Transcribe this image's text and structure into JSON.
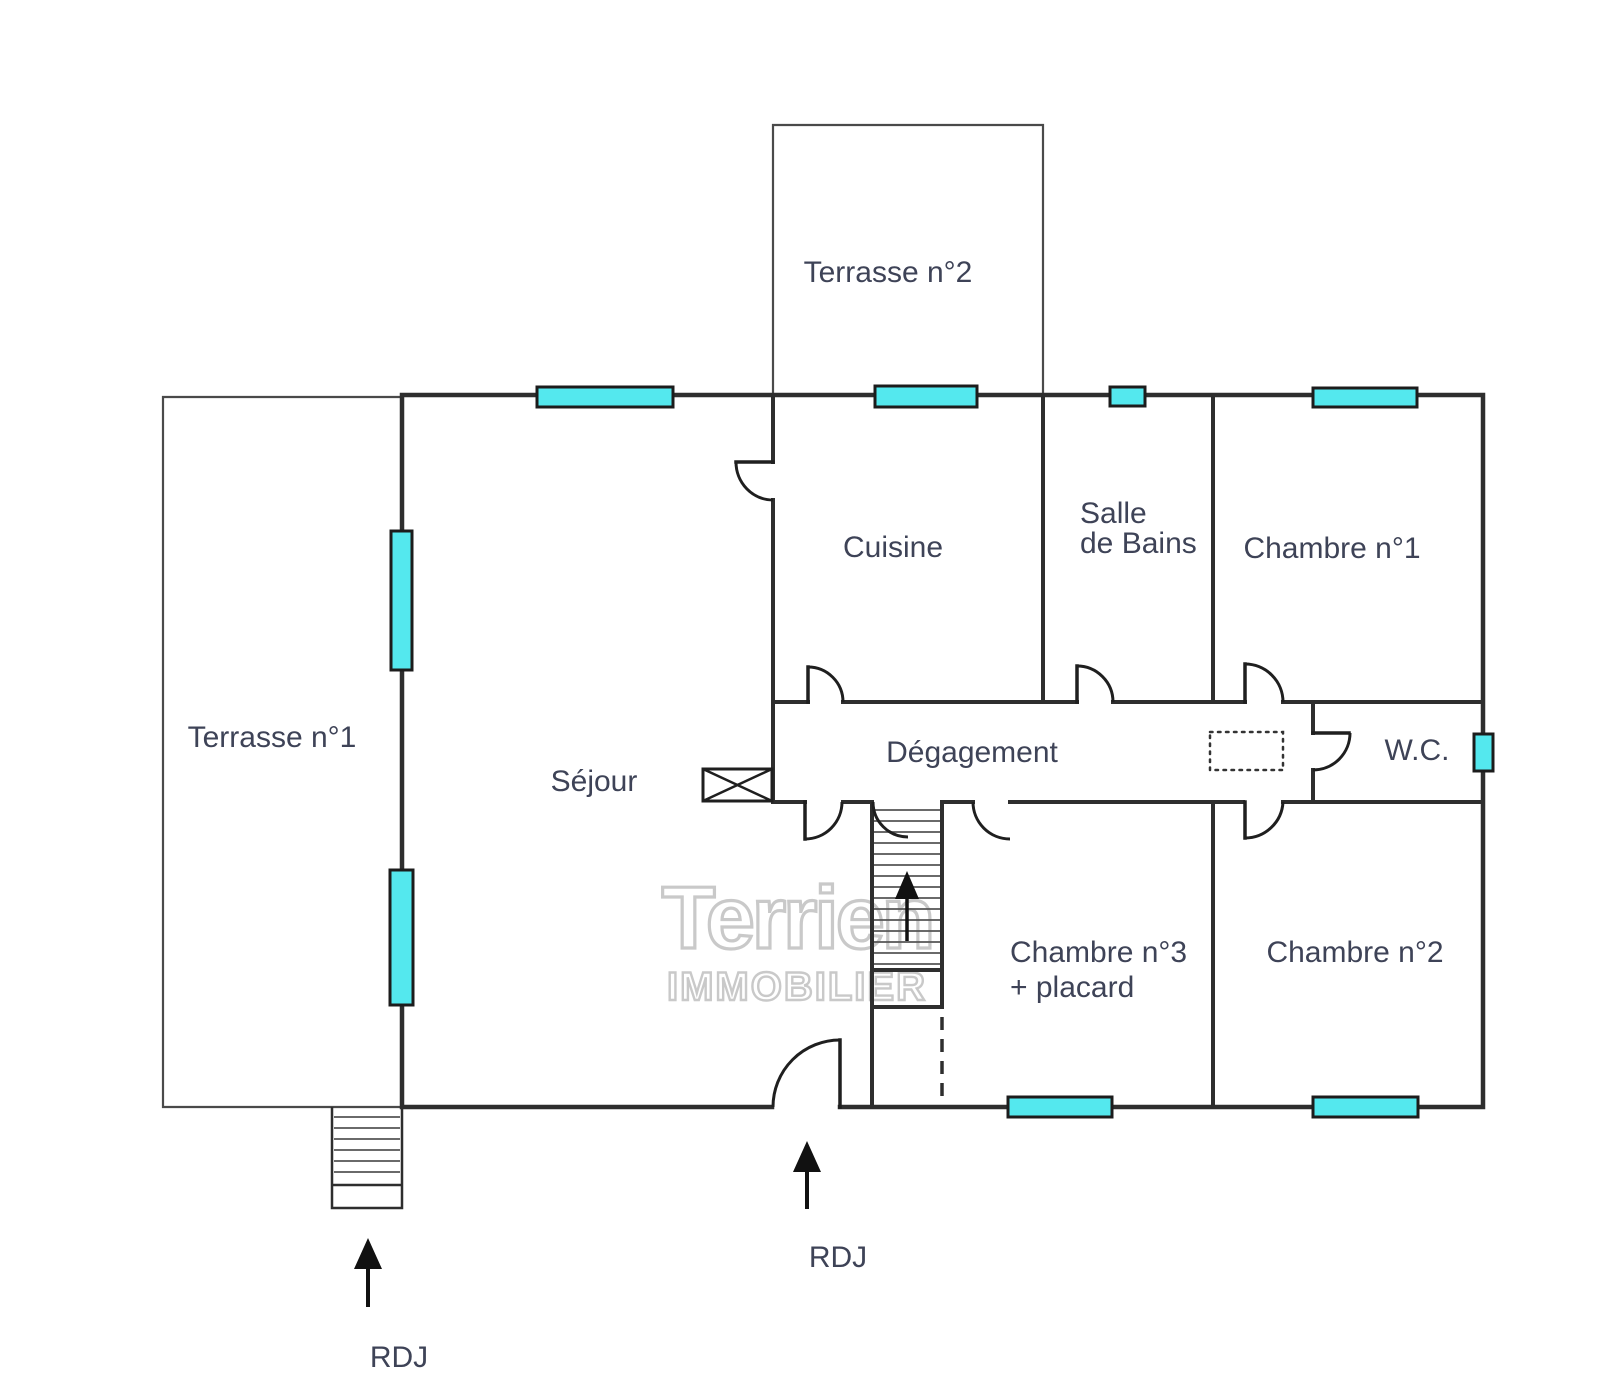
{
  "colors": {
    "wall": "#2e2e2e",
    "line": "#1f1f1f",
    "terrace_line": "#4a4a4a",
    "window_fill": "#54e8ee",
    "window_border": "#1c1c1c",
    "label": "#3e4357",
    "arrow": "#111111",
    "tread": "#555555",
    "watermark": "#c9c9c9"
  },
  "rooms": {
    "terrasse2": "Terrasse n°2",
    "terrasse1": "Terrasse n°1",
    "sejour": "Séjour",
    "cuisine": "Cuisine",
    "salle_de_bains_line1": "Salle",
    "salle_de_bains_line2": "de Bains",
    "chambre1": "Chambre n°1",
    "degagement": "Dégagement",
    "wc": "W.C.",
    "chambre3_line1": "Chambre n°3",
    "chambre3_line2": "+ placard",
    "chambre2": "Chambre n°2"
  },
  "annotations": {
    "rdj_left": "RDJ",
    "rdj_center": "RDJ"
  },
  "icons": {
    "rdj_arrow_left": "up-arrow",
    "rdj_arrow_center": "up-arrow",
    "stairs_arrow": "up-arrow"
  },
  "watermark": {
    "line1": "Terrien",
    "line2": "IMMOBILIER"
  }
}
